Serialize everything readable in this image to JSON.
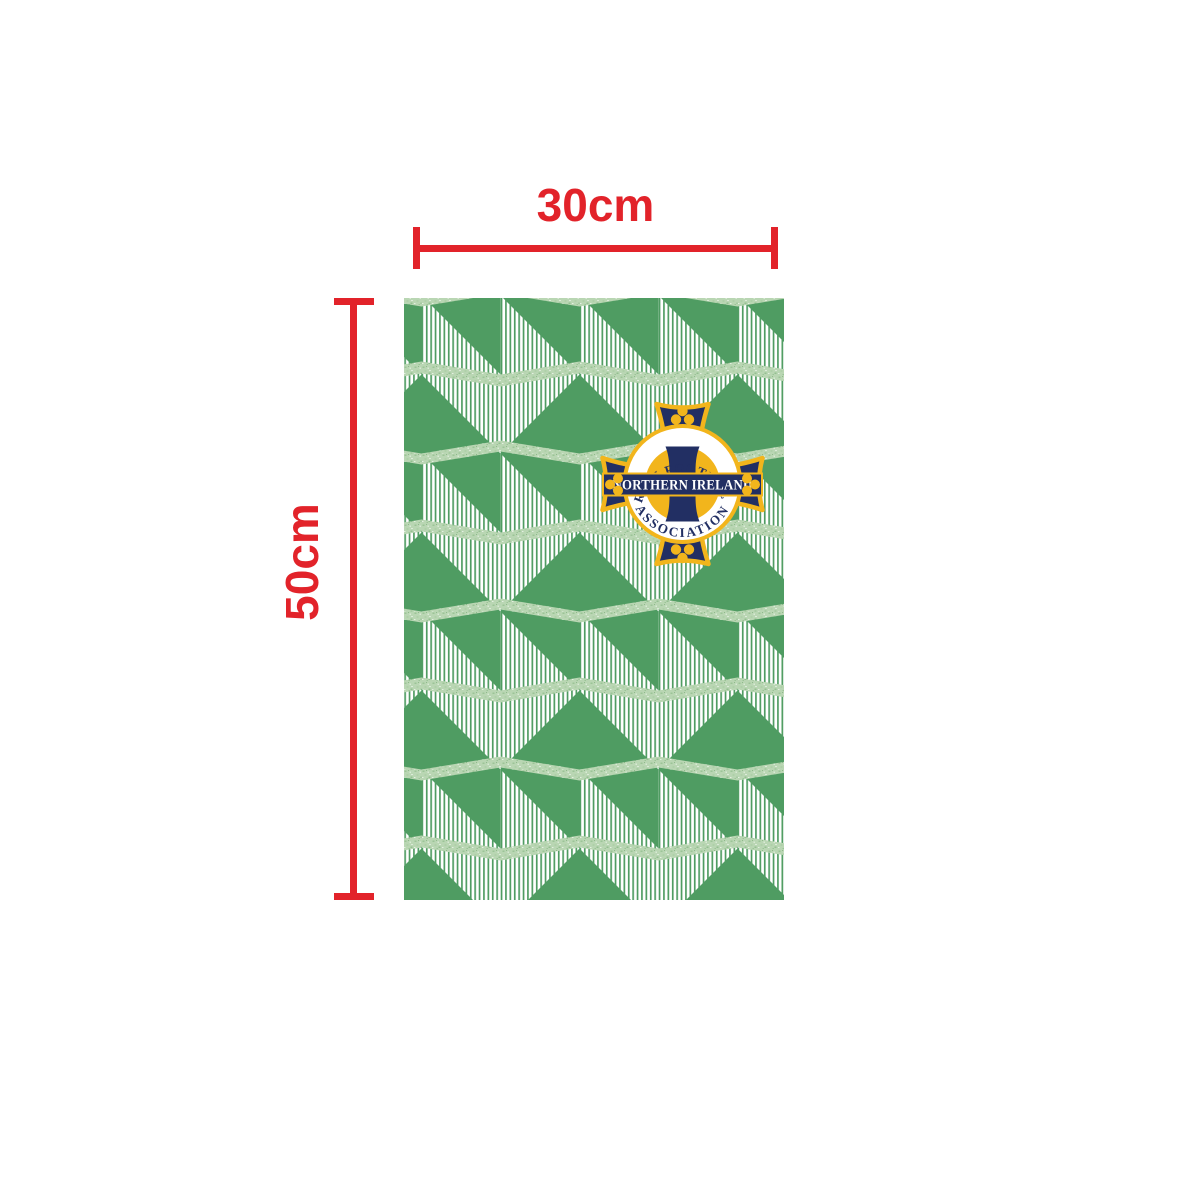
{
  "annotation": {
    "width_label": "30cm",
    "height_label": "50cm",
    "line_color": "#e2232a"
  },
  "panel": {
    "description": "geometric cube pattern panel",
    "green": "#4f9c62",
    "light_green": "#bad7b4",
    "stripe_white": "#ffffff"
  },
  "crest": {
    "arc_top": "IRISH FOOTBALL",
    "arc_bottom": "ASSOCIATION",
    "banner": "NORTHERN IRELAND",
    "navy": "#222f63",
    "yellow": "#f2b51c",
    "white": "#ffffff"
  }
}
